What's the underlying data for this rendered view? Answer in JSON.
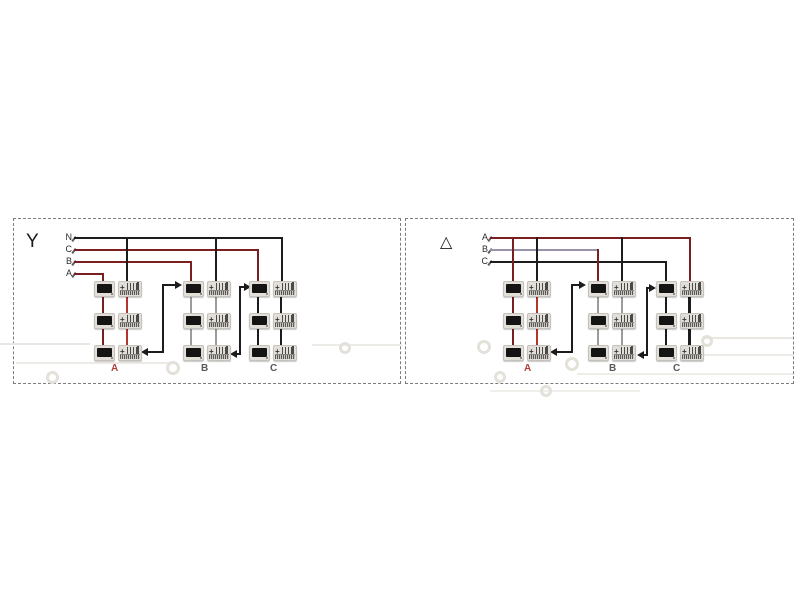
{
  "page": {
    "background": "#ffffff"
  },
  "device": {
    "w": 48,
    "h": 16,
    "display_w": 21,
    "screen": {
      "x": 2,
      "y": 2,
      "w": 15,
      "h": 9
    },
    "terminal_x": 24,
    "terminal_w": 24,
    "plus": "+",
    "body_color": "#e2dfd9",
    "border_color": "#c6c2bb",
    "screen_color": "#141414",
    "pin_color": "#4a4a4a",
    "strip_color": "#5a5a5a"
  },
  "decor": {
    "ring_color": "#e4e1db",
    "lines": [
      {
        "x": 0,
        "y": 343,
        "w": 90,
        "h": 2,
        "c": "#eae7e2"
      },
      {
        "x": 312,
        "y": 344,
        "w": 90,
        "h": 2,
        "c": "#edebe6"
      },
      {
        "x": 16,
        "y": 362,
        "w": 158,
        "h": 2,
        "c": "#edebe6"
      },
      {
        "x": 703,
        "y": 337,
        "w": 90,
        "h": 2,
        "c": "#eae7e2"
      },
      {
        "x": 703,
        "y": 354,
        "w": 90,
        "h": 2,
        "c": "#edebe6"
      },
      {
        "x": 577,
        "y": 373,
        "w": 216,
        "h": 2,
        "c": "#efede8"
      },
      {
        "x": 490,
        "y": 390,
        "w": 150,
        "h": 2,
        "c": "#f1efeb"
      }
    ],
    "rings": [
      {
        "cx": 52,
        "cy": 377,
        "d": 13
      },
      {
        "cx": 173,
        "cy": 368,
        "d": 14
      },
      {
        "cx": 345,
        "cy": 348,
        "d": 12
      },
      {
        "cx": 484,
        "cy": 347,
        "d": 14
      },
      {
        "cx": 572,
        "cy": 364,
        "d": 14
      },
      {
        "cx": 500,
        "cy": 377,
        "d": 12
      },
      {
        "cx": 707,
        "cy": 341,
        "d": 12
      },
      {
        "cx": 546,
        "cy": 391,
        "d": 12
      }
    ]
  },
  "panels": [
    {
      "id": "wye",
      "symbol": "Y",
      "frame": {
        "x": 13,
        "y": 218,
        "w": 388,
        "h": 166
      },
      "symbol_pos": {
        "x": 25,
        "y": 231,
        "size": 19
      },
      "bus_labels": [
        {
          "text": "N",
          "x": 58,
          "y": 232,
          "w": 14,
          "c": "#2b2b2b"
        },
        {
          "text": "C",
          "x": 58,
          "y": 244,
          "w": 14,
          "c": "#2b2b2b"
        },
        {
          "text": "B",
          "x": 58,
          "y": 256,
          "w": 14,
          "c": "#2b2b2b"
        },
        {
          "text": "A",
          "x": 58,
          "y": 268,
          "w": 14,
          "c": "#2b2b2b"
        }
      ],
      "wires": [
        {
          "x": 74,
          "y": 237,
          "w": 209,
          "h": 2,
          "c": "#1c1c1c"
        },
        {
          "x": 74,
          "y": 249,
          "w": 185,
          "h": 2,
          "c": "#7a1f1f"
        },
        {
          "x": 74,
          "y": 261,
          "w": 118,
          "h": 2,
          "c": "#7a1f1f"
        },
        {
          "x": 74,
          "y": 273,
          "w": 30,
          "h": 2,
          "c": "#7a1f1f"
        },
        {
          "x": 102,
          "y": 273,
          "w": 2,
          "h": 9,
          "c": "#7a1f1f"
        },
        {
          "x": 126,
          "y": 237,
          "w": 2,
          "h": 45,
          "c": "#1c1c1c"
        },
        {
          "x": 190,
          "y": 261,
          "w": 2,
          "h": 21,
          "c": "#7a1f1f"
        },
        {
          "x": 215,
          "y": 237,
          "w": 2,
          "h": 45,
          "c": "#1c1c1c"
        },
        {
          "x": 257,
          "y": 249,
          "w": 2,
          "h": 33,
          "c": "#7a1f1f"
        },
        {
          "x": 281,
          "y": 237,
          "w": 2,
          "h": 45,
          "c": "#1c1c1c"
        },
        {
          "x": 102,
          "y": 297,
          "w": 2,
          "h": 16,
          "c": "#7a1f1f"
        },
        {
          "x": 126,
          "y": 297,
          "w": 2,
          "h": 16,
          "c": "#b5342e"
        },
        {
          "x": 102,
          "y": 329,
          "w": 2,
          "h": 16,
          "c": "#7a1f1f"
        },
        {
          "x": 126,
          "y": 329,
          "w": 2,
          "h": 16,
          "c": "#b5342e"
        },
        {
          "x": 190,
          "y": 297,
          "w": 2,
          "h": 16,
          "c": "#9c9c9c"
        },
        {
          "x": 215,
          "y": 297,
          "w": 2,
          "h": 16,
          "c": "#9c9c9c"
        },
        {
          "x": 190,
          "y": 329,
          "w": 2,
          "h": 16,
          "c": "#9c9c9c"
        },
        {
          "x": 215,
          "y": 329,
          "w": 2,
          "h": 16,
          "c": "#9c9c9c"
        },
        {
          "x": 257,
          "y": 297,
          "w": 2,
          "h": 16,
          "c": "#1c1c1c"
        },
        {
          "x": 280,
          "y": 297,
          "w": 2,
          "h": 16,
          "c": "#1c1c1c"
        },
        {
          "x": 257,
          "y": 329,
          "w": 2,
          "h": 16,
          "c": "#1c1c1c"
        },
        {
          "x": 280,
          "y": 329,
          "w": 2,
          "h": 16,
          "c": "#1c1c1c"
        }
      ],
      "arrows": {
        "color": "#1c1c1c",
        "segments": [
          {
            "x": 162,
            "y": 284,
            "w": 2,
            "h": 69
          },
          {
            "x": 162,
            "y": 284,
            "w": 14,
            "h": 2
          },
          {
            "x": 147,
            "y": 351,
            "w": 17,
            "h": 2
          },
          {
            "x": 239,
            "y": 286,
            "w": 2,
            "h": 69
          },
          {
            "x": 239,
            "y": 286,
            "w": 6,
            "h": 2
          },
          {
            "x": 236,
            "y": 353,
            "w": 5,
            "h": 2
          }
        ],
        "heads": [
          {
            "x": 182,
            "y": 285,
            "dir": "right"
          },
          {
            "x": 141,
            "y": 352,
            "dir": "left"
          },
          {
            "x": 251,
            "y": 287,
            "dir": "right"
          },
          {
            "x": 230,
            "y": 354,
            "dir": "left"
          }
        ]
      },
      "columns": [
        {
          "x": 94,
          "label": "A",
          "label_x": 111,
          "label_c": "#b24040"
        },
        {
          "x": 183,
          "label": "B",
          "label_x": 201,
          "label_c": "#5a5a5a"
        },
        {
          "x": 249,
          "label": "C",
          "label_x": 270,
          "label_c": "#5a5a5a"
        }
      ],
      "device_rows": [
        281,
        313,
        345
      ],
      "column_label_y": 363
    },
    {
      "id": "delta",
      "symbol": "△",
      "frame": {
        "x": 405,
        "y": 218,
        "w": 389,
        "h": 166
      },
      "symbol_pos": {
        "x": 439,
        "y": 234,
        "size": 16
      },
      "bus_labels": [
        {
          "text": "A",
          "x": 474,
          "y": 232,
          "w": 14,
          "c": "#2b2b2b"
        },
        {
          "text": "B",
          "x": 474,
          "y": 244,
          "w": 14,
          "c": "#2b2b2b"
        },
        {
          "text": "C",
          "x": 474,
          "y": 256,
          "w": 14,
          "c": "#2b2b2b"
        }
      ],
      "wires": [
        {
          "x": 490,
          "y": 237,
          "w": 201,
          "h": 2,
          "c": "#7a1f1f"
        },
        {
          "x": 490,
          "y": 249,
          "w": 109,
          "h": 2,
          "c": "#9a92ab"
        },
        {
          "x": 490,
          "y": 261,
          "w": 177,
          "h": 2,
          "c": "#1c1c1c"
        },
        {
          "x": 512,
          "y": 237,
          "w": 2,
          "h": 45,
          "c": "#7a1f1f"
        },
        {
          "x": 536,
          "y": 237,
          "w": 2,
          "h": 45,
          "c": "#1c1c1c"
        },
        {
          "x": 597,
          "y": 249,
          "w": 2,
          "h": 33,
          "c": "#7a1f1f"
        },
        {
          "x": 621,
          "y": 237,
          "w": 2,
          "h": 45,
          "c": "#1c1c1c"
        },
        {
          "x": 665,
          "y": 261,
          "w": 2,
          "h": 21,
          "c": "#1c1c1c"
        },
        {
          "x": 689,
          "y": 237,
          "w": 2,
          "h": 45,
          "c": "#7a1f1f"
        },
        {
          "x": 512,
          "y": 297,
          "w": 2,
          "h": 16,
          "c": "#7a1f1f"
        },
        {
          "x": 536,
          "y": 297,
          "w": 2,
          "h": 16,
          "c": "#b5342e"
        },
        {
          "x": 512,
          "y": 329,
          "w": 2,
          "h": 16,
          "c": "#7a1f1f"
        },
        {
          "x": 536,
          "y": 329,
          "w": 2,
          "h": 16,
          "c": "#b5342e"
        },
        {
          "x": 597,
          "y": 297,
          "w": 2,
          "h": 16,
          "c": "#9c9c9c"
        },
        {
          "x": 621,
          "y": 297,
          "w": 2,
          "h": 16,
          "c": "#9c9c9c"
        },
        {
          "x": 597,
          "y": 329,
          "w": 2,
          "h": 16,
          "c": "#9c9c9c"
        },
        {
          "x": 621,
          "y": 329,
          "w": 2,
          "h": 16,
          "c": "#9c9c9c"
        },
        {
          "x": 665,
          "y": 297,
          "w": 2,
          "h": 16,
          "c": "#1c1c1c"
        },
        {
          "x": 688,
          "y": 296,
          "w": 3,
          "h": 18,
          "c": "#1c1c1c"
        },
        {
          "x": 665,
          "y": 329,
          "w": 2,
          "h": 16,
          "c": "#1c1c1c"
        },
        {
          "x": 688,
          "y": 328,
          "w": 3,
          "h": 18,
          "c": "#1c1c1c"
        }
      ],
      "arrows": {
        "color": "#1c1c1c",
        "segments": [
          {
            "x": 571,
            "y": 284,
            "w": 2,
            "h": 69
          },
          {
            "x": 571,
            "y": 284,
            "w": 9,
            "h": 2
          },
          {
            "x": 556,
            "y": 351,
            "w": 17,
            "h": 2
          },
          {
            "x": 646,
            "y": 287,
            "w": 2,
            "h": 69
          },
          {
            "x": 646,
            "y": 287,
            "w": 5,
            "h": 2
          },
          {
            "x": 643,
            "y": 354,
            "w": 4,
            "h": 2
          }
        ],
        "heads": [
          {
            "x": 586,
            "y": 285,
            "dir": "right"
          },
          {
            "x": 550,
            "y": 352,
            "dir": "left"
          },
          {
            "x": 656,
            "y": 288,
            "dir": "right"
          },
          {
            "x": 637,
            "y": 355,
            "dir": "left"
          }
        ]
      },
      "columns": [
        {
          "x": 503,
          "label": "A",
          "label_x": 524,
          "label_c": "#b24040"
        },
        {
          "x": 588,
          "label": "B",
          "label_x": 609,
          "label_c": "#5a5a5a"
        },
        {
          "x": 656,
          "label": "C",
          "label_x": 673,
          "label_c": "#5a5a5a"
        }
      ],
      "device_rows": [
        281,
        313,
        345
      ],
      "column_label_y": 363
    }
  ]
}
